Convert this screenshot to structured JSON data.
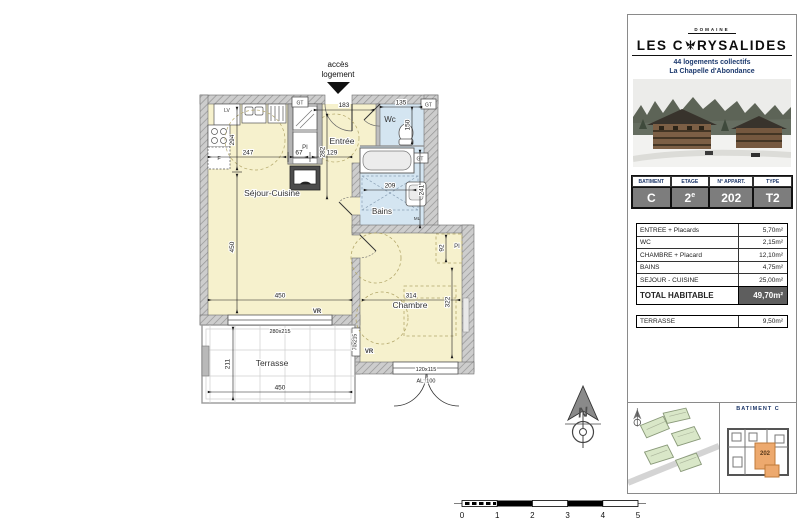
{
  "plan": {
    "access_label_line1": "accès",
    "access_label_line2": "logement",
    "rooms": {
      "sejour": "Séjour-Cuisine",
      "entree": "Entrée",
      "wc": "Wc",
      "bains": "Bains",
      "chambre": "Chambre",
      "terrasse": "Terrasse"
    },
    "fixtures": {
      "lv": "LV",
      "f": "F",
      "ml": "ML",
      "pi": "PI",
      "gt": "GT",
      "vr": "VR"
    },
    "dims": {
      "entree_w": "183",
      "wc_w": "135",
      "wc_d": "150",
      "kitchen_w": "247",
      "closet_w": "67",
      "hall_w": "129",
      "kitchen_d": "294",
      "entree_d": "282",
      "sejour_w": "450",
      "sejour_d": "450",
      "bains_w": "209",
      "bains_d": "241",
      "chambre_w": "314",
      "chambre_d": "322",
      "placard_d": "92",
      "window_sejour": "280x215",
      "window_chambre": "120x115",
      "allege": "AL: 100",
      "door_terrasse": "70x215",
      "terrasse_w": "450",
      "terrasse_d": "211"
    },
    "scale_ticks": [
      "0",
      "1",
      "2",
      "3",
      "4",
      "5"
    ]
  },
  "sidebar": {
    "brand": {
      "domaine": "DOMAINE",
      "name_pre": "LES C",
      "name_post": "RYSALIDES",
      "subtitle1": "44 logements collectifs",
      "subtitle2": "La Chapelle d'Abondance"
    },
    "unit_table": {
      "headers": [
        "BATIMENT",
        "ETAGE",
        "N° APPART.",
        "TYPE"
      ],
      "values": [
        "C",
        "2",
        "202",
        "T2"
      ],
      "etage_sup": "e"
    },
    "areas": {
      "rows": [
        {
          "label": "ENTREE + Placards",
          "value": "5,70m²"
        },
        {
          "label": "WC",
          "value": "2,15m²"
        },
        {
          "label": "CHAMBRE + Placard",
          "value": "12,10m²"
        },
        {
          "label": "BAINS",
          "value": "4,75m²"
        },
        {
          "label": "SEJOUR - CUISINE",
          "value": "25,00m²"
        }
      ],
      "total_label": "TOTAL HABITABLE",
      "total_value": "49,70m²",
      "terrace_label": "TERRASSE",
      "terrace_value": "9,50m²"
    },
    "map": {
      "batiment_label": "BATIMENT  C",
      "unit_number": "202"
    }
  },
  "colors": {
    "room_yellow": "#f6f1cd",
    "room_blue": "#d4e5f1",
    "wall_gray": "#cdcdcd",
    "highlight_orange": "#eda96e"
  }
}
